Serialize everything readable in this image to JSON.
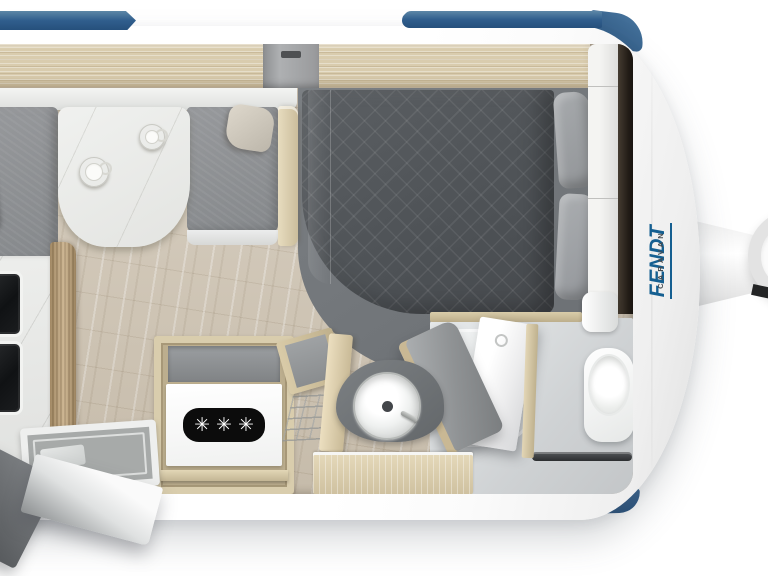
{
  "scene": {
    "type": "caravan floor plan, top-down product render",
    "brand": {
      "name": "FENDT",
      "subtitle": "CARAVAN"
    },
    "fridge": {
      "freezer_symbol": "✳✳✳"
    },
    "colors": {
      "accent_blue": "#2f5d8c",
      "body_white": "#fdfdfd",
      "cabinet_wood": "#d8cbab",
      "floor_wood": "#d0c6b6",
      "upholstery_gray": "#8f9295",
      "bedding_gray": "#54585c",
      "dark_trim": "#2a241e"
    },
    "icons": {
      "freezer_stars": "freezer-stars-icon",
      "coffee_cups": "coffee-cup-icon",
      "sink": "kitchen-sink-icon",
      "toilet": "toilet-icon",
      "jockey_wheel": "jockey-wheel-icon"
    }
  }
}
